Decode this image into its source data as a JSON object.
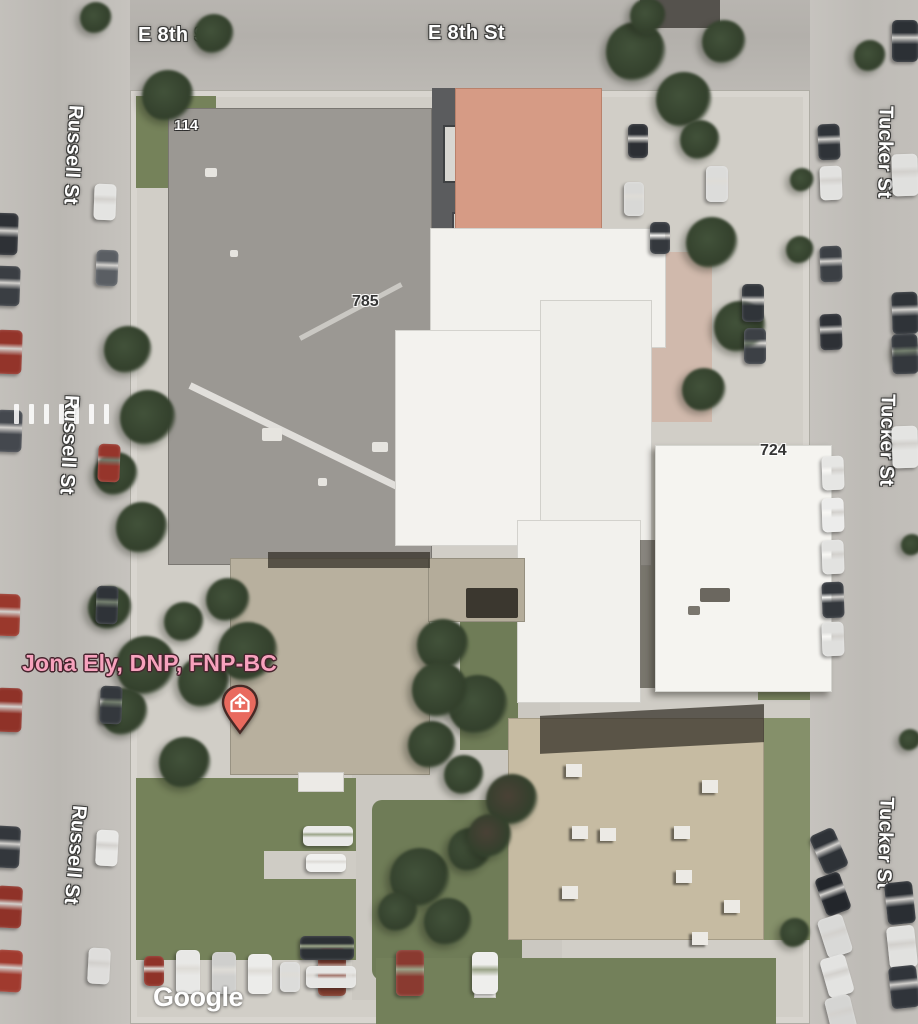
{
  "streets": {
    "e8th": "E 8th St",
    "russell": "Russell St",
    "tucker": "Tucker St"
  },
  "buildings": {
    "n114": "114",
    "n785": "785",
    "n724": "724",
    "n2_partial": "2"
  },
  "poi": {
    "name": "Jona Ely, DNP, FNP-BC",
    "pin_icon": "medical-house-pin",
    "pin_color": "#e96a5e",
    "pin_outline": "#472a26",
    "label_color": "#f7a2bd"
  },
  "attribution": {
    "logo": "Google"
  },
  "colors": {
    "road": "#bab7b2",
    "sidewalk": "#d1cec7",
    "grass": "#75825a",
    "tree": "#42523a",
    "roof_gray": "#9b9893",
    "roof_white": "#f2f1ed",
    "roof_tan": "#c6bba2",
    "roof_beige": "#b8b09e",
    "roof_salmon": "#d69b85"
  }
}
